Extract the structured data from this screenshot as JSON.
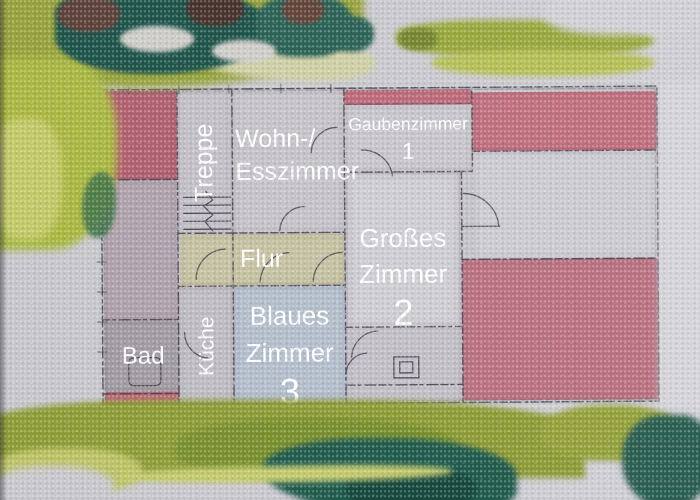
{
  "artwork": {
    "kind": "watercolor floor plan painting",
    "language": "German"
  },
  "palette": {
    "paper": "#cac9ce",
    "pencil": "#4b4752",
    "roof_pink": "#c0707e",
    "foliage_olive": "#93a138",
    "foliage_teal": "#1d5449",
    "flur_tan": "#c6c2a2",
    "blue_room_wash": "#b4bfcc",
    "label_text": "#ffffff"
  },
  "rooms": [
    {
      "id": "treppe",
      "label": "Treppe"
    },
    {
      "id": "wohn-esszimmer",
      "label": "Wohn-/\nEsszimmer"
    },
    {
      "id": "gaubenzimmer",
      "label": "Gaubenzimmer",
      "number": "1"
    },
    {
      "id": "flur",
      "label": "Flur"
    },
    {
      "id": "grosses-zimmer",
      "label": "Großes\nZimmer",
      "number": "2"
    },
    {
      "id": "blaues-zimmer",
      "label": "Blaues\nZimmer",
      "number": "3"
    },
    {
      "id": "kueche",
      "label": "Küche"
    },
    {
      "id": "bad",
      "label": "Bad"
    }
  ]
}
